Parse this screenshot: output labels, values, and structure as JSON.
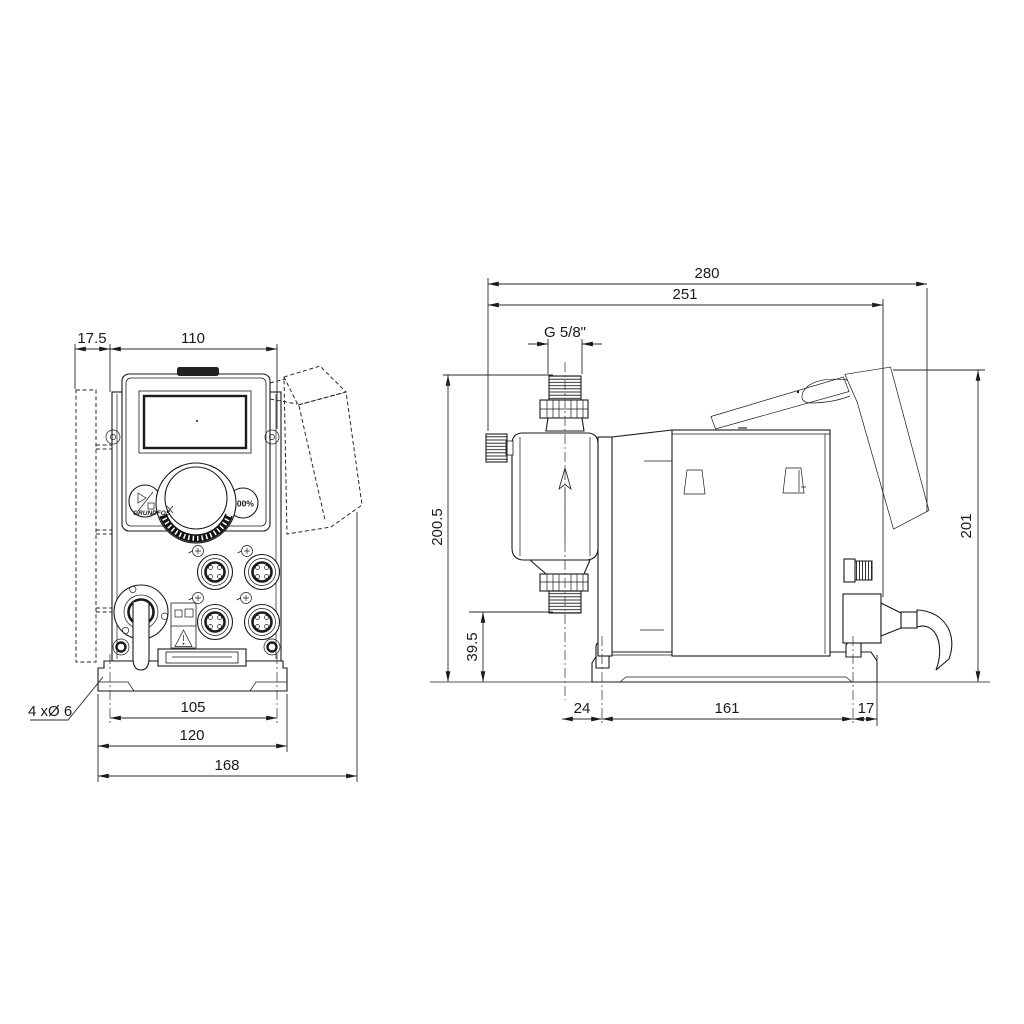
{
  "drawing": {
    "type": "technical dimensional drawing, dosing pump, front and side views",
    "units": "mm",
    "colors": {
      "line": "#1a1a1a",
      "background": "#ffffff",
      "dim_line": "#2a2a2a"
    }
  },
  "front_view": {
    "dimensions": {
      "bracket_offset": "17.5",
      "panel_width": "110",
      "hole_spacing": "105",
      "plate_width": "120",
      "overall_width": "168",
      "holes_note": "4 xØ 6"
    },
    "panel": {
      "button_100_label": "100%",
      "logo_text": "GRUNDFOS"
    }
  },
  "side_view": {
    "dimensions": {
      "overall_depth": "280",
      "depth_to_gland": "251",
      "connection_thread": "G 5/8\"",
      "overall_height": "200.5",
      "suction_valve_height": "39.5",
      "rear_height": "201",
      "valve_to_front_hole": "24",
      "hole_spacing_depth": "161",
      "rear_hole_to_edge": "17"
    }
  }
}
